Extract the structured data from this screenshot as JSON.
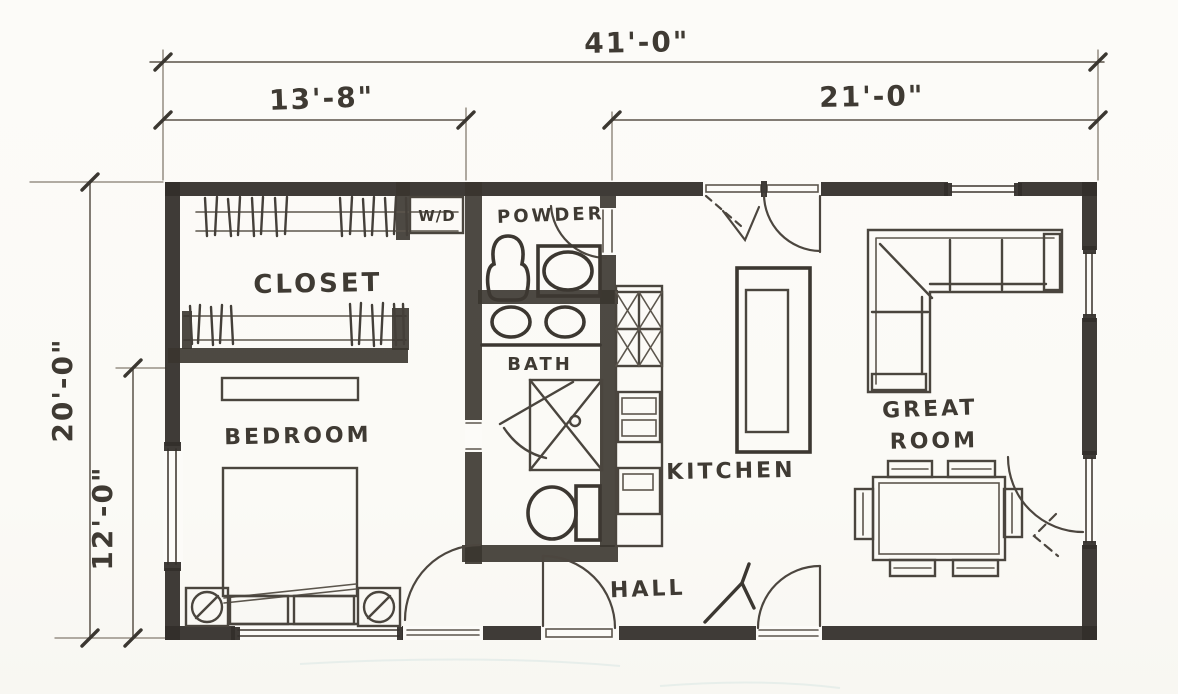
{
  "drawing": {
    "type": "hand-sketched residential floor plan",
    "colors": {
      "paper": "#fcfbf8",
      "wall_ink": "#332f2a",
      "pencil_line": "#4a453e",
      "dim_line": "#5a5349"
    }
  },
  "dimensions": {
    "overall_width": "41'-0\"",
    "left_section_width": "13'-8\"",
    "right_section_width": "21'-0\"",
    "overall_depth": "20'-0\"",
    "bedroom_depth": "12'-0\""
  },
  "rooms": {
    "closet": "CLOSET",
    "washer_dryer": "W/D",
    "powder": "POWDER",
    "bath": "BATH",
    "kitchen": "KITCHEN",
    "great_room": {
      "line1": "GREAT",
      "line2": "ROOM"
    },
    "bedroom": "BEDROOM",
    "hall": "HALL"
  }
}
